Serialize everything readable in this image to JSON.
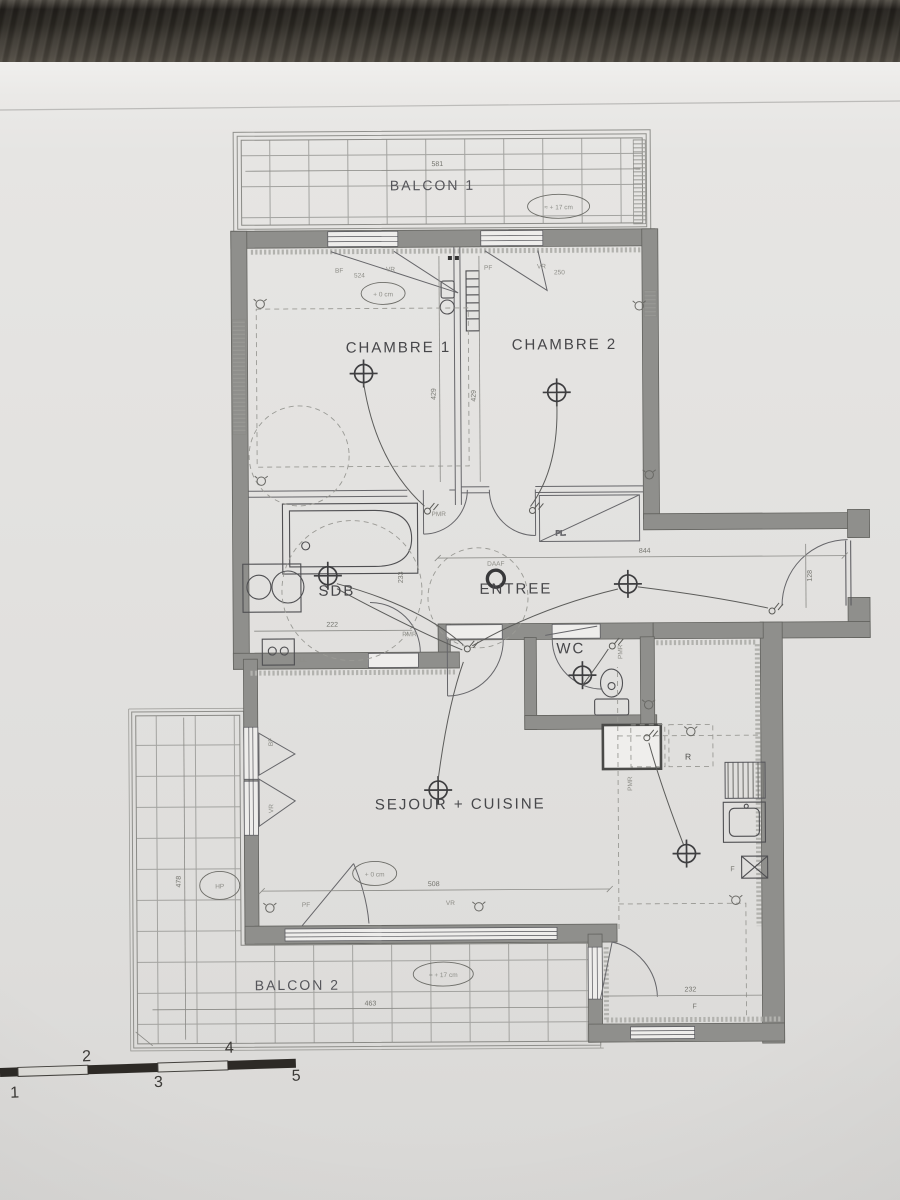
{
  "rooms": {
    "balcon1": "BALCON 1",
    "chambre1": "CHAMBRE 1",
    "chambre2": "CHAMBRE 2",
    "sdb": "SDB",
    "entree": "ENTREE",
    "wc": "WC",
    "sejour": "SEJOUR + CUISINE",
    "balcon2": "BALCON 2"
  },
  "levels": {
    "balcon1": "≈ + 17 cm",
    "balcon2": "≈ + 17 cm",
    "chambre1": "+ 0 cm",
    "sejour": "+ 0 cm"
  },
  "dimensions": {
    "balcon1_width": "581",
    "chambre1_window": "524",
    "chambre2_window": "250",
    "chambre1_depth": "429",
    "chambre2_depth": "429",
    "sdb_width": "222",
    "sdb_depth": "233",
    "hall_length": "844",
    "hall_width": "128",
    "sejour_width": "508",
    "balcon2_left_depth": "478",
    "balcon2_width": "463",
    "corner_width": "232"
  },
  "window_labels": {
    "bf1": "BF",
    "vr1": "VR",
    "pf2": "PF",
    "vr2": "VR",
    "pf3": "PF",
    "vr3": "VR",
    "bf4": "BF",
    "vr4": "VR"
  },
  "annotations": {
    "daaf": "DAAF",
    "placard": "PL.",
    "pmr": [
      "PMR",
      "PMR",
      "PMR",
      "PMR"
    ],
    "washer": "LL",
    "fridge": "R",
    "oven": "F",
    "corner_window": "F",
    "hp": "HP"
  },
  "scale_bar": {
    "ticks": [
      "1",
      "2",
      "3",
      "4",
      "5"
    ]
  },
  "colors": {
    "paper": "#e4e3e1",
    "wood": "#3e3a33",
    "wall": "#8f8f8c",
    "ink": "#4a4a4e"
  }
}
